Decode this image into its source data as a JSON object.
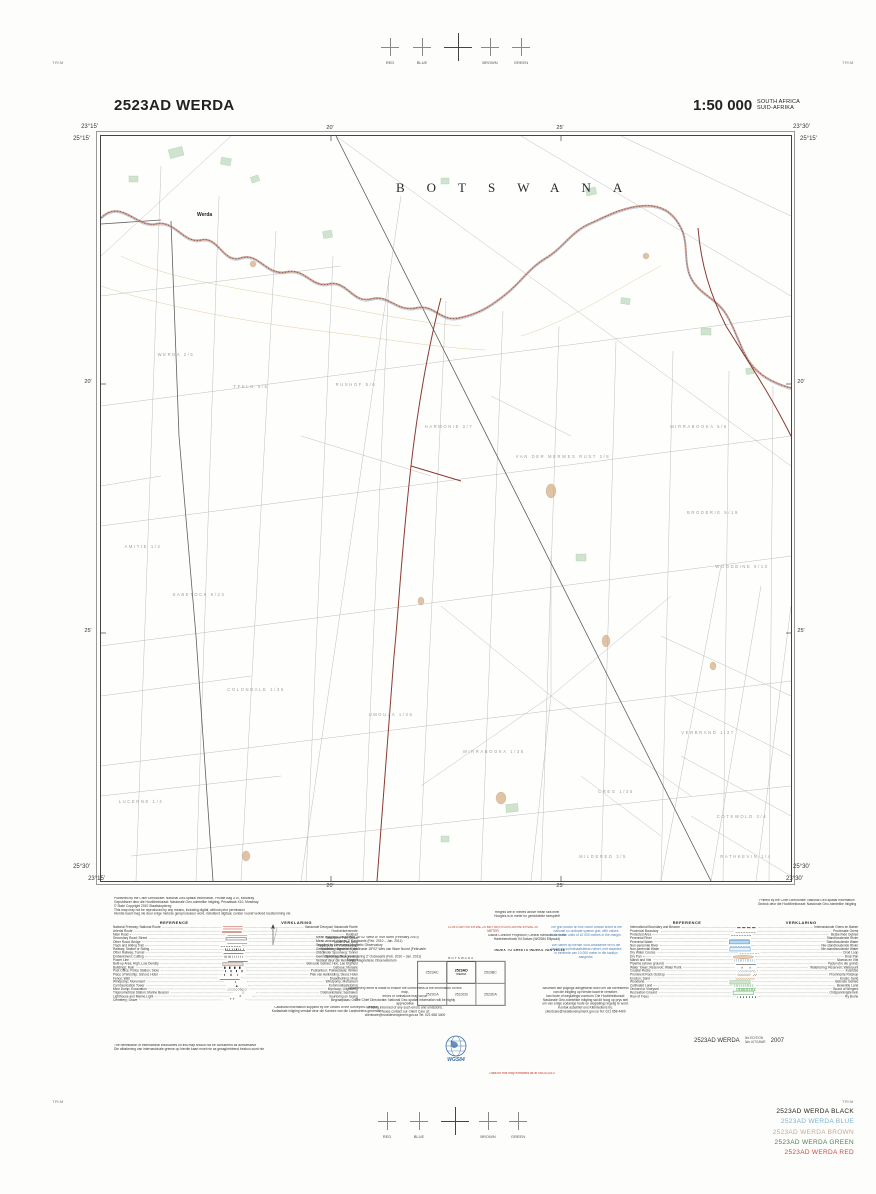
{
  "header": {
    "sheet_title": "2523AD WERDA",
    "scale": "1:50 000",
    "country_line1": "SOUTH AFRICA",
    "country_line2": "SUID-AFRIKA"
  },
  "registration": {
    "trim": "TRIM",
    "colors": [
      "RED",
      "BLUE",
      "BROWN",
      "GREEN"
    ]
  },
  "map": {
    "corners": {
      "tl_lon": "23°15'",
      "tl_lat": "25°15'",
      "tr_lon": "23°30'",
      "tr_lat": "25°15'",
      "bl_lat": "25°30'",
      "bl_lon": "23°15'",
      "br_lat": "25°30'",
      "br_lon": "23°30'"
    },
    "edge_ticks": {
      "first": "20'",
      "second": "25'"
    },
    "labels": [
      {
        "text": "BOTSWANA",
        "x": 295,
        "y": 56,
        "cls": "lbl-country"
      },
      {
        "text": "Werda",
        "x": 96,
        "y": 80,
        "cls": "lbl-town"
      },
      {
        "text": "WERDA 2/5",
        "x": 75,
        "y": 220,
        "cls": "lbl-farm"
      },
      {
        "text": "TFELO 3/5",
        "x": 150,
        "y": 252,
        "cls": "lbl-farm"
      },
      {
        "text": "RUSHOF 5/6",
        "x": 255,
        "y": 250,
        "cls": "lbl-farm"
      },
      {
        "text": "HARMONIE 2/7",
        "x": 348,
        "y": 292,
        "cls": "lbl-farm"
      },
      {
        "text": "VAN DER MERWES RUST 2/8",
        "x": 462,
        "y": 322,
        "cls": "lbl-farm"
      },
      {
        "text": "MIRRABOOKA 5/6",
        "x": 598,
        "y": 292,
        "cls": "lbl-farm"
      },
      {
        "text": "BRODERIE 5/19",
        "x": 612,
        "y": 378,
        "cls": "lbl-farm"
      },
      {
        "text": "AMITIE 1/2",
        "x": 42,
        "y": 412,
        "cls": "lbl-farm"
      },
      {
        "text": "WOODBINE 6/10",
        "x": 641,
        "y": 432,
        "cls": "lbl-farm"
      },
      {
        "text": "SABETOCK 5/23",
        "x": 98,
        "y": 460,
        "cls": "lbl-farm"
      },
      {
        "text": "COLONDALE 1/35",
        "x": 155,
        "y": 555,
        "cls": "lbl-farm"
      },
      {
        "text": "UMGUZA 1/35",
        "x": 290,
        "y": 580,
        "cls": "lbl-farm"
      },
      {
        "text": "MIRRABOOKA 1/35",
        "x": 393,
        "y": 617,
        "cls": "lbl-farm"
      },
      {
        "text": "VERBRAND 1/37",
        "x": 607,
        "y": 598,
        "cls": "lbl-farm"
      },
      {
        "text": "CREG 1/35",
        "x": 515,
        "y": 657,
        "cls": "lbl-farm"
      },
      {
        "text": "LUCERNE 1/4",
        "x": 40,
        "y": 667,
        "cls": "lbl-farm"
      },
      {
        "text": "COTSWOLD 3/4",
        "x": 641,
        "y": 682,
        "cls": "lbl-farm"
      },
      {
        "text": "MILDERED 3/5",
        "x": 502,
        "y": 722,
        "cls": "lbl-farm"
      },
      {
        "text": "RATHKEVIN 1/4",
        "x": 645,
        "y": 722,
        "cls": "lbl-farm"
      }
    ]
  },
  "footer": {
    "published": [
      "Published by the Chief Directorate: National Geo-spatial Information, Private Bag X10, Mowbray",
      "Gepubliseer deur die Hoofdirektoraat: Nasionale Geo-ruimtelike Inligting, Privaatsak X10, Mowbray",
      "© State Copyright  2010  Staatskopiereg",
      "This map may not be reproduced by any means, including digital, without prior permission",
      "Hierdie kaart mag nie deur enige metode gereproduseer word, insluitend digitaal, sonder vooraf verkreë toestemming nie"
    ],
    "printed": [
      "Printed by the Chief Directorate: National Geo-spatial Information",
      "Gedruk deur die Hoofdirektoraat: Nasionale Geo-ruimtelike Inligting"
    ],
    "heights": [
      "Heights are in metres above mean sea level",
      "Hoogtes is in meter bo gemiddelde seespieël"
    ],
    "contour": "CONTOUR INTERVAL 20 METRES   KONTOERINTERVAL 20 METER",
    "projection": [
      "Gauss Conform Projection; Central Meridian 23° East",
      "Hartebeesthoek 94 Datum (WGS84 Ellipsoid)"
    ],
    "magnetic": [
      "Mean magnetic declination 18°02' West of True North (February 2010)",
      "Mean annual change 2' Eastwards (Feb. 2010 – Jan. 2011)",
      "Supplied by Hermanus Magnetic Observatory",
      "Gemiddelde magnetiese deklinasie 18°02' Wes van Ware Noord (Februarie 2010)",
      "Gemiddelde jaarlikse verandering 2' Ooswaarts (Feb. 2010 – Jan. 2011)",
      "Verskaf deur die Hermanus Magnetiese Observatorium"
    ],
    "grid_note_en": [
      "The grid shown on this South African sheet is the",
      "national co-ordinate system grid, with values",
      "indicated in units of 10 000 metres in the margin."
    ],
    "grid_note_af": [
      "Die ruitnet op hierdie Suid-Afrikaanse vel is die",
      "nasionale koördinaatstelsel-ruitnet, met waardes",
      "in eenhede van 10 000 meter in die kantlyn aangedui."
    ],
    "index": {
      "heading": "INDEX TO SHEETS    INDEKS VAN VELLE",
      "top_label": "BOTSWANA",
      "cells": [
        "2523AC",
        "2523AD",
        "2523BC",
        "2523CA",
        "2523CB",
        "2523DA"
      ],
      "center_sub": "WERDA"
    },
    "errors_en": [
      "While every effort is made to ensure the correctness of the information on this map,",
      "errors or omissions may occur.",
      "The Chief Directorate: National Geo-spatial Information will be highly appreciative",
      "of being informed of any such errors and omissions.",
      "Please contact our Client Care at:",
      "clientcare@ruraldevelopment.gov.za      Tel: 021 658 4400"
    ],
    "errors_af": [
      "Alhoewel alle pogings aangewend word om die korrektheid",
      "van die inligting op hierdie kaart te verseker,",
      "kan foute of weglatings voorkom. Die Hoofdirektoraat:",
      "Nasionale Geo-ruimtelike Inligting sal dit hoog op prys stel",
      "om van enige sodanige foute en weglatings ingelig te word.",
      "Kontak asseblief ons Kliëntediens by:",
      "clientcare@ruraldevelopment.gov.za      Tel: 021 658 4400"
    ],
    "legend_note": [
      "Cadastral information supplied by the Offices of the Surveyors-General",
      "Kadastrale inligting verskaf deur die Kantore van die Landmeters-generaal"
    ],
    "delimitation": [
      "The delimitation of international boundaries on this map should not be considered as authoritative",
      "Die afbakening van internasionale grense op hierdie kaart moet nie as gesaghebbend beskou word nie"
    ],
    "legend_left": {
      "heading_en": "REFERENCE",
      "heading_af": "VERKLARING",
      "rows": [
        {
          "en": "National Freeway; National Route",
          "af": "Nasionale Deurpad; Nasionale Roete",
          "sym": "road-dual"
        },
        {
          "en": "Arterial Route",
          "af": "Hoofverkeersroete",
          "sym": "road-art"
        },
        {
          "en": "Main Road",
          "af": "Hoofpad",
          "sym": "road-main"
        },
        {
          "en": "Secondary Road; Street",
          "af": "Sekondêre Pad; Straat",
          "sym": "road-sec"
        },
        {
          "en": "Other Road; Bridge",
          "af": "Ander Pad; Brug",
          "sym": "road-other"
        },
        {
          "en": "Track and Hiking Trail",
          "af": "Tweespoor en Voetslaanpad",
          "sym": "track"
        },
        {
          "en": "Railway; Station or Siding",
          "af": "Spoorweg; Stasie of Sylyn",
          "sym": "rail"
        },
        {
          "en": "Other Railway; Tunnel",
          "af": "Ander Spoorweg; Tonnel",
          "sym": "rail2"
        },
        {
          "en": "Embankment; Cutting",
          "af": "Opvulling; Deurgrawing",
          "sym": "embank"
        },
        {
          "en": "Power Line",
          "af": "Kraglyn",
          "sym": "power"
        },
        {
          "en": "Built-up Area; High, Low Density",
          "af": "Beboude Gebied; Hoë, Lae Digtheid",
          "sym": "builtup"
        },
        {
          "en": "Buildings; Ruin",
          "af": "Geboue; Murasie",
          "sym": "buildings"
        },
        {
          "en": "Post Office; Police Station; Store",
          "af": "Poskantoor; Polisiestasie; Winkel",
          "sym": "offices"
        },
        {
          "en": "Place of Worship; School; Hotel",
          "af": "Plek van Aanbidding; Skool; Hotel",
          "sym": "worship"
        },
        {
          "en": "Fence; Wall",
          "af": "Draadheining; Muur",
          "sym": "fence"
        },
        {
          "en": "Windpump; Monument",
          "af": "Windpomp; Monument",
          "sym": "windpump"
        },
        {
          "en": "Communication Tower",
          "af": "Kommunikasietoring",
          "sym": "commtower"
        },
        {
          "en": "Mine Dump; Excavation",
          "af": "Mynhoop; Uitgrawing",
          "sym": "minedump"
        },
        {
          "en": "Trigonometrical Station; Marine Beacon",
          "af": "Driehoekstasie; Seebaken",
          "sym": "trig"
        },
        {
          "en": "Lighthouse and Marine Light",
          "af": "Vuurtoring en Seelig",
          "sym": "lighthouse"
        },
        {
          "en": "Cemetery; Grave",
          "af": "Begraafplaas; Graf",
          "sym": "cemetery"
        }
      ]
    },
    "legend_right": {
      "heading_en": "REFERENCE",
      "heading_af": "VERKLARING",
      "rows": [
        {
          "en": "International Boundary and Beacon",
          "af": "Internasionale Grens en Baken",
          "sym": "intl"
        },
        {
          "en": "Provincial Boundary",
          "af": "Provinsiale Grens",
          "sym": "prov"
        },
        {
          "en": "Protected Area",
          "af": "Beskermde Gebied",
          "sym": "protected"
        },
        {
          "en": "Perennial River",
          "af": "Standhoudende Rivier",
          "sym": "river-p"
        },
        {
          "en": "Perennial Water",
          "af": "Standhoudende Water",
          "sym": "water-p"
        },
        {
          "en": "Non-perennial River",
          "af": "Nie-standhoudende Rivier",
          "sym": "river-np"
        },
        {
          "en": "Non-perennial Water",
          "af": "Nie-standhoudende Water",
          "sym": "water-np"
        },
        {
          "en": "Dry Water Course",
          "af": "Droë Loop",
          "sym": "drycourse"
        },
        {
          "en": "Dry Pan",
          "af": "Droë Pan",
          "sym": "drypan"
        },
        {
          "en": "Marsh and Vlei",
          "af": "Moeras en Vlei",
          "sym": "marsh"
        },
        {
          "en": "Pipeline (above ground)",
          "af": "Pyplyn (bo die grond)",
          "sym": "pipeline"
        },
        {
          "en": "Water Tower; Reservoir; Water Point",
          "af": "Watertoring; Reservoir; Waterpunt",
          "sym": "watertower"
        },
        {
          "en": "Coastal Rocks",
          "af": "Kusrotse",
          "sym": "coastal"
        },
        {
          "en": "Prominent Rock Outcrop",
          "af": "Prominente Rotskop",
          "sym": "rockout"
        },
        {
          "en": "Erosion; Sand",
          "af": "Erosie; Sand",
          "sym": "erosion"
        },
        {
          "en": "Woodland",
          "af": "Beboste Gebied",
          "sym": "woodland"
        },
        {
          "en": "Cultivated Land",
          "af": "Bewerkte Land",
          "sym": "cultivated"
        },
        {
          "en": "Orchard or Vineyard",
          "af": "Boord of Wingerd",
          "sym": "orchard"
        },
        {
          "en": "Recreation Ground",
          "af": "Ontspanningsterrein",
          "sym": "recreation"
        },
        {
          "en": "Row of Trees",
          "af": "Ry Bome",
          "sym": "rowtrees"
        }
      ]
    },
    "wgs84": "WGS84",
    "extraction": "Data for this map extracted as at 08/02/2010",
    "edition": {
      "sheet": "2523AD WERDA",
      "edition_en": "3rd EDITION",
      "edition_af": "3de UITGAWE",
      "year": "2007"
    },
    "plates": [
      {
        "label": "2523AD WERDA BLACK",
        "color": "#232323"
      },
      {
        "label": "2523AD WERDA BLUE",
        "color": "#7ab3d4"
      },
      {
        "label": "2523AD WERDA BROWN",
        "color": "#c9a696"
      },
      {
        "label": "2523AD WERDA GREEN",
        "color": "#4e7d5b"
      },
      {
        "label": "2523AD WERDA RED",
        "color": "#c64a42"
      }
    ]
  }
}
